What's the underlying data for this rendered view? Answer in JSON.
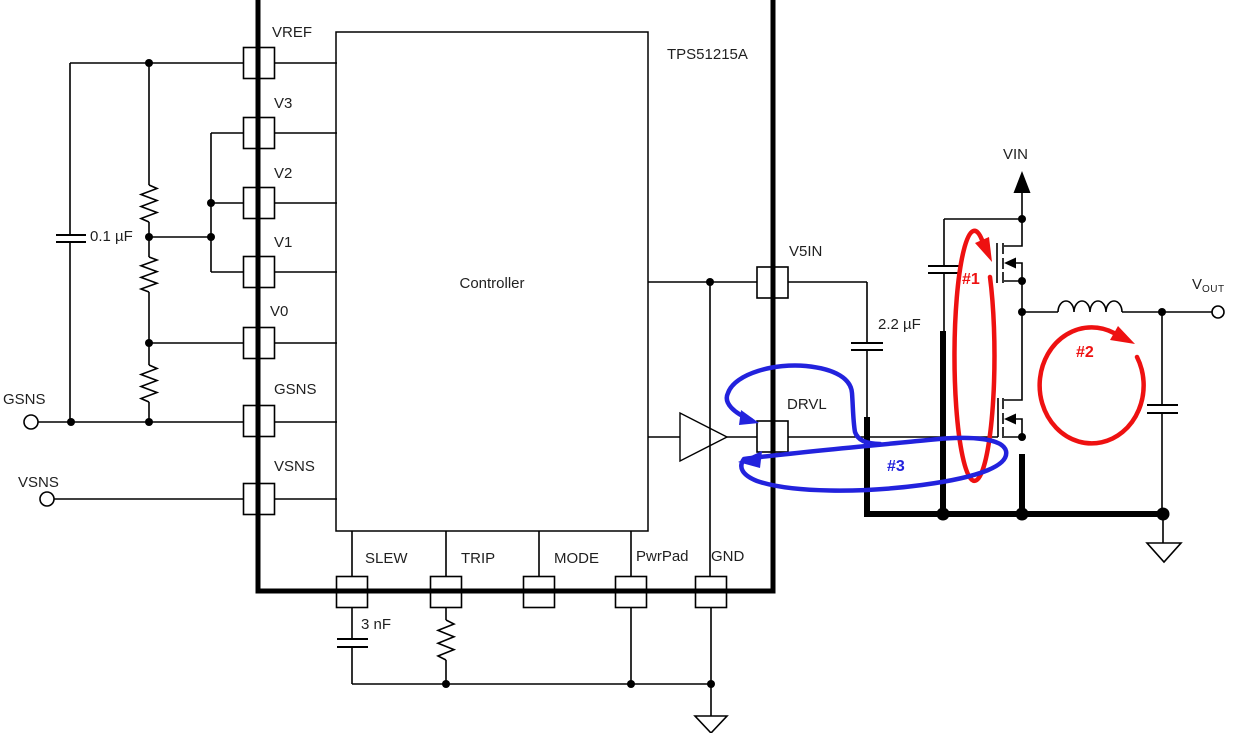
{
  "figure": {
    "part_number": "TPS51215A",
    "block_label": "Controller"
  },
  "pins": {
    "left": [
      "VREF",
      "V3",
      "V2",
      "V1",
      "V0",
      "GSNS",
      "VSNS"
    ],
    "bottom": [
      "SLEW",
      "TRIP",
      "MODE",
      "PwrPad",
      "GND"
    ],
    "right": [
      "V5IN",
      "DRVL"
    ]
  },
  "terminals": {
    "gsns": "GSNS",
    "vsns": "VSNS",
    "vin": "VIN",
    "vout_base": "V",
    "vout_sub": "OUT"
  },
  "components": {
    "vref_cap": "0.1 µF",
    "v5in_cap": "2.2 µF",
    "slew_cap": "3 nF"
  },
  "loops": {
    "loop1": "#1",
    "loop2": "#2",
    "loop3": "#3"
  },
  "colors": {
    "loop_red": "#ee1111",
    "loop_blue": "#2222dd",
    "wire": "#000000"
  }
}
